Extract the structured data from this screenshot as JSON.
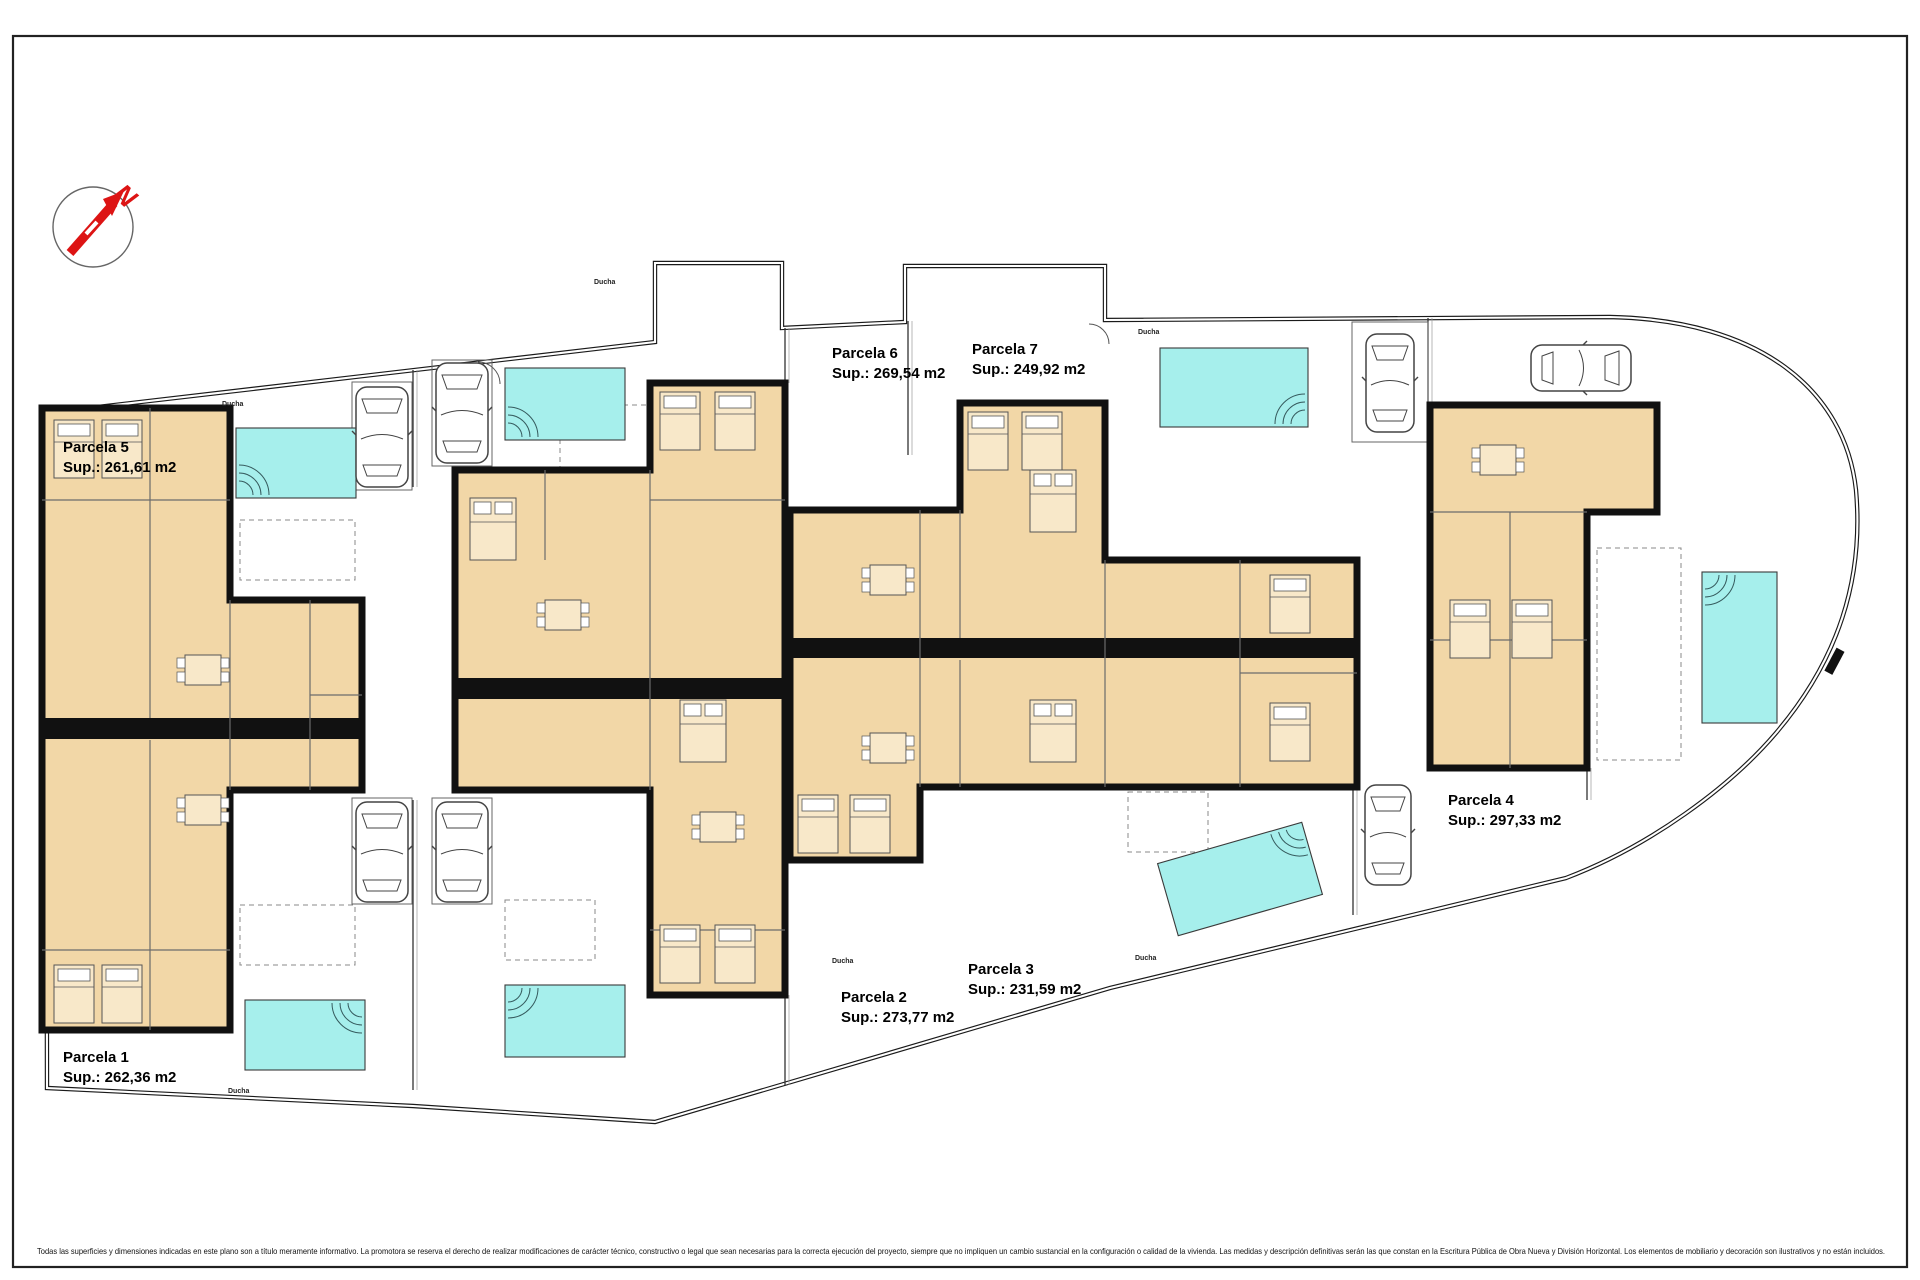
{
  "plan": {
    "title_hint": "site-plan",
    "north_label": "N",
    "shower_label": "Ducha",
    "colors": {
      "accent_magenta": "#c000c0",
      "room_fill": "#f2d7a7",
      "room_fill_light": "#f8e8c9",
      "pool_fill": "#a6efec",
      "wall_color": "#111111",
      "boundary_color": "#222222",
      "interior_line": "#6b6b6b",
      "compass_red": "#dd1414",
      "car_stroke": "#444444"
    },
    "parcels": [
      {
        "id": "parcela-1",
        "name": "Parcela 1",
        "sup": "Sup.: 262,36 m2"
      },
      {
        "id": "parcela-2",
        "name": "Parcela 2",
        "sup": "Sup.: 273,77 m2"
      },
      {
        "id": "parcela-3",
        "name": "Parcela 3",
        "sup": "Sup.: 231,59 m2"
      },
      {
        "id": "parcela-4",
        "name": "Parcela 4",
        "sup": "Sup.: 297,33 m2"
      },
      {
        "id": "parcela-5",
        "name": "Parcela 5",
        "sup": "Sup.: 261,61 m2"
      },
      {
        "id": "parcela-6",
        "name": "Parcela 6",
        "sup": "Sup.: 269,54 m2"
      },
      {
        "id": "parcela-7",
        "name": "Parcela 7",
        "sup": "Sup.: 249,92 m2"
      }
    ]
  },
  "footer": {
    "disclaimer": "Todas las superficies y dimensiones indicadas en este plano son a título meramente informativo. La promotora se reserva el derecho de realizar modificaciones de carácter técnico, constructivo o legal que sean necesarias para la correcta ejecución del proyecto, siempre que no impliquen un cambio sustancial en la configuración o calidad de la vivienda. Las medidas y descripción definitivas serán las que constan en la Escritura Pública de Obra Nueva y División Horizontal. Los elementos de mobiliario y decoración son ilustrativos y no están incluidos."
  }
}
